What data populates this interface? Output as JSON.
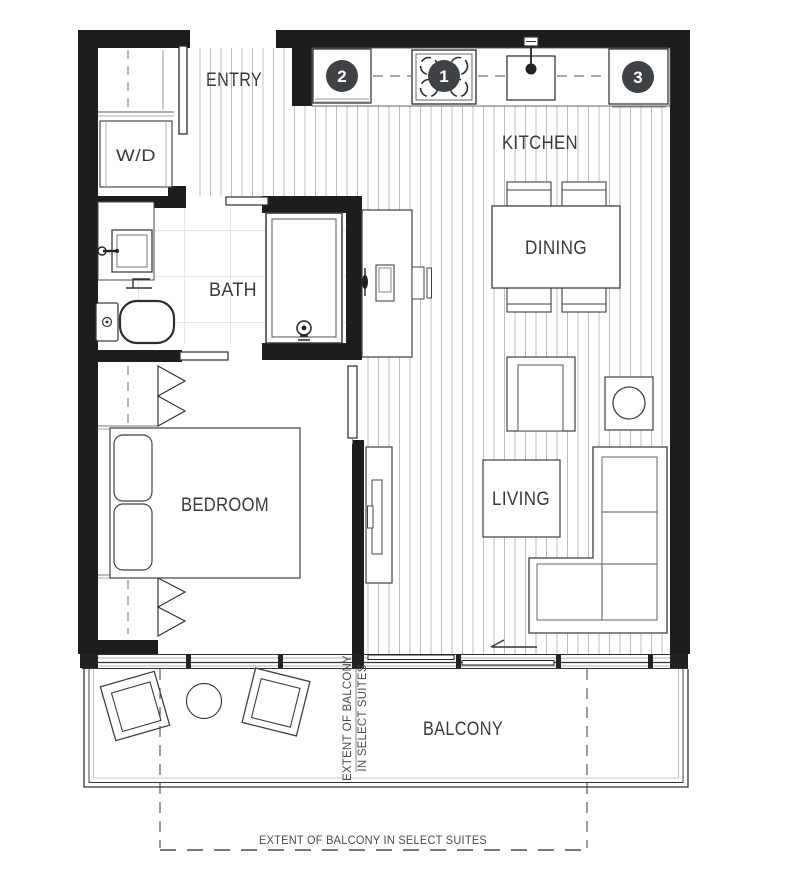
{
  "labels": {
    "entry": "ENTRY",
    "washer_dryer": "W/D",
    "bath": "BATH",
    "kitchen": "KITCHEN",
    "dining": "DINING",
    "bedroom": "BEDROOM",
    "living": "LIVING",
    "balcony": "BALCONY"
  },
  "markers": {
    "stove": "1",
    "counter_appliance": "2",
    "fridge": "3"
  },
  "annotations": {
    "extent_vertical_line1": "EXTENT OF BALCONY",
    "extent_vertical_line2": "IN SELECT SUITES",
    "extent_bottom": "EXTENT OF BALCONY IN SELECT SUITES"
  },
  "colors": {
    "wall": "#1d1d1f",
    "marker_badge": "#3e4245",
    "fixture_line": "#3f3f3f",
    "hatch_line": "#b5b5b5",
    "tile_line": "#cdcdcd",
    "text": "#3a3a3a",
    "background": "#ffffff"
  }
}
